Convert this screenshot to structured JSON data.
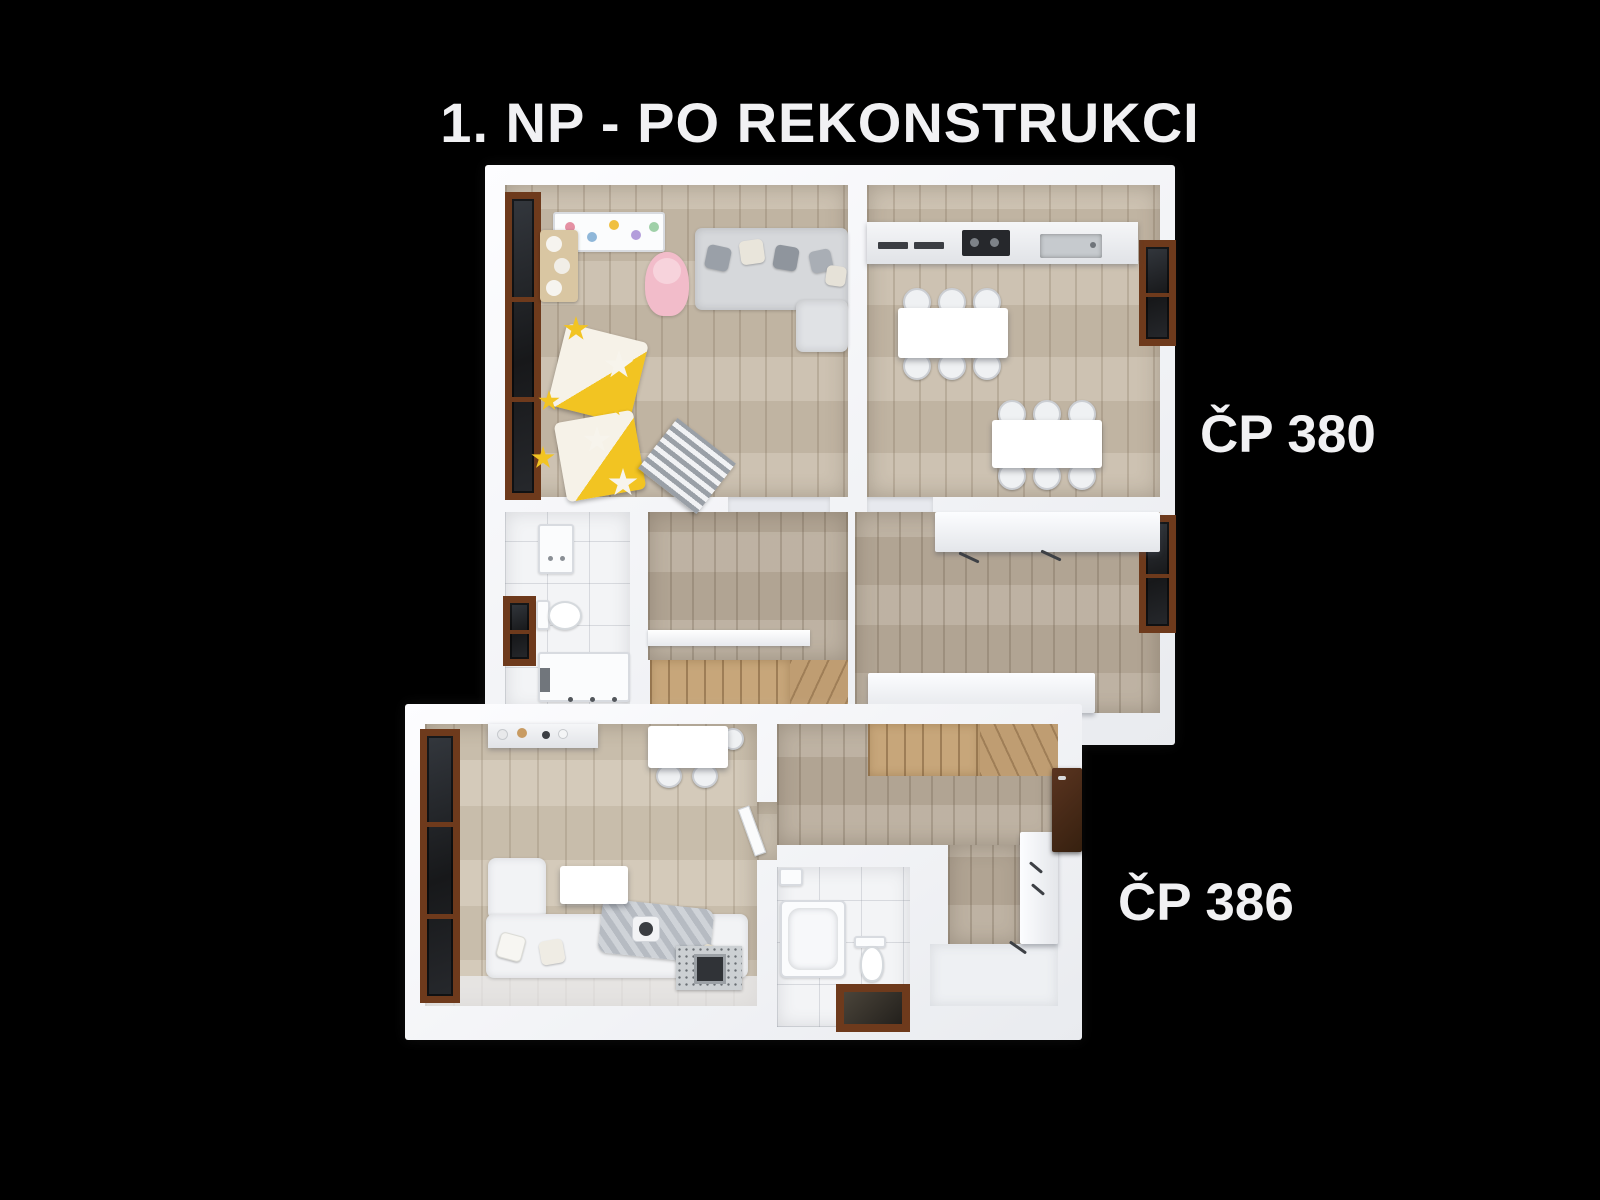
{
  "header": {
    "title": "1. NP - PO REKONSTRUKCI"
  },
  "units": [
    {
      "id": "cp-380",
      "label": "ČP 380",
      "rooms": [
        "playroom-living-room",
        "kitchen-dining-room",
        "bathroom",
        "hallway",
        "staircase",
        "bedroom"
      ]
    },
    {
      "id": "cp-386",
      "label": "ČP 386",
      "rooms": [
        "living-room-with-kitchenette",
        "hallway",
        "staircase",
        "bathroom",
        "entry"
      ]
    }
  ],
  "colors": {
    "background": "#000000",
    "wall": "#f4f5f8",
    "wood_a": "#c8bcaa",
    "wood_b": "#b9ac9b",
    "wood_c": "#cfc4b2",
    "tile": "#f3f4f6",
    "window_frame": "#6e3a1c",
    "glass": "#17181a",
    "stair": "#c7a67a",
    "yellow": "#f2c422",
    "pink": "#f2bcca",
    "sofa": "#d6d8db"
  }
}
